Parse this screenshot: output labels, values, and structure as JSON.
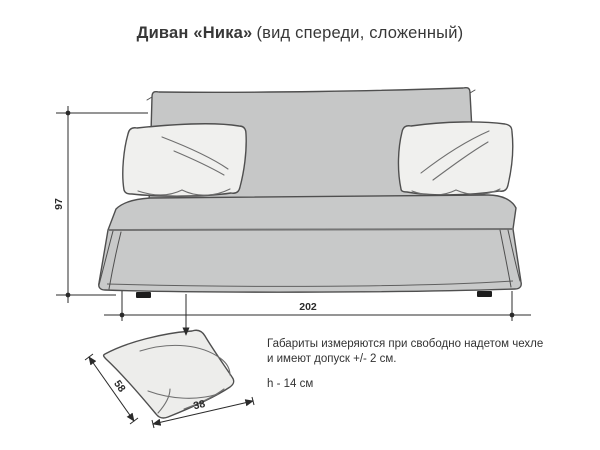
{
  "title": {
    "product": "Диван «Ника»",
    "view": "(вид спереди, сложенный)"
  },
  "dimensions": {
    "sofa_height_cm": "97",
    "sofa_width_cm": "202",
    "pillow_depth_cm": "58",
    "pillow_width_cm": "38"
  },
  "notes": {
    "tolerance_line1": "Габариты измеряются при свободно надетом чехле",
    "tolerance_line2": "и имеют допуск +/- 2 см.",
    "pillow_height": "h - 14 см"
  },
  "colors": {
    "background": "#ffffff",
    "sofa_fill": "#c8c9c9",
    "backrest_fill": "#c6c7c7",
    "pillow_fill": "#f0f0ee",
    "detail_pillow_fill": "#ededeb",
    "outline": "#4f4f4f",
    "crease": "#6f6f6f",
    "dim": "#2b2b2b",
    "feet": "#1d1d1d",
    "text": "#333333"
  }
}
